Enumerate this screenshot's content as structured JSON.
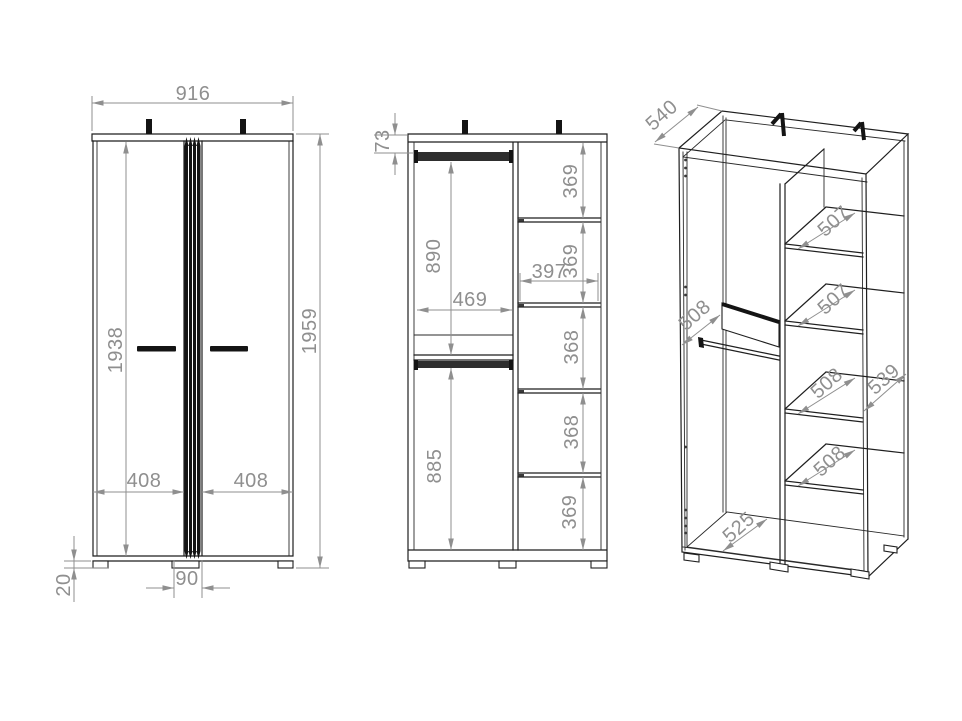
{
  "front_view": {
    "overall_width": "916",
    "overall_height": "1959",
    "door_height": "1938",
    "left_door_width": "408",
    "right_door_width": "408",
    "center_trim_width": "90",
    "plinth_height": "20"
  },
  "interior_view": {
    "rail_to_top": "73",
    "upper_section_height": "890",
    "lower_section_height": "885",
    "left_section_width": "469",
    "right_section_width": "397",
    "shelf_spacings": [
      "369",
      "369",
      "368",
      "368",
      "369"
    ]
  },
  "perspective_view": {
    "outer_depth": "540",
    "interior_depth": "508",
    "shelf_depths": [
      "507",
      "507",
      "508",
      "508"
    ],
    "side_panel_depth": "539",
    "floor_depth": "525"
  },
  "colors": {
    "outline": "#1f1f1f",
    "dimension": "#8f8f8f",
    "background": "#ffffff"
  }
}
